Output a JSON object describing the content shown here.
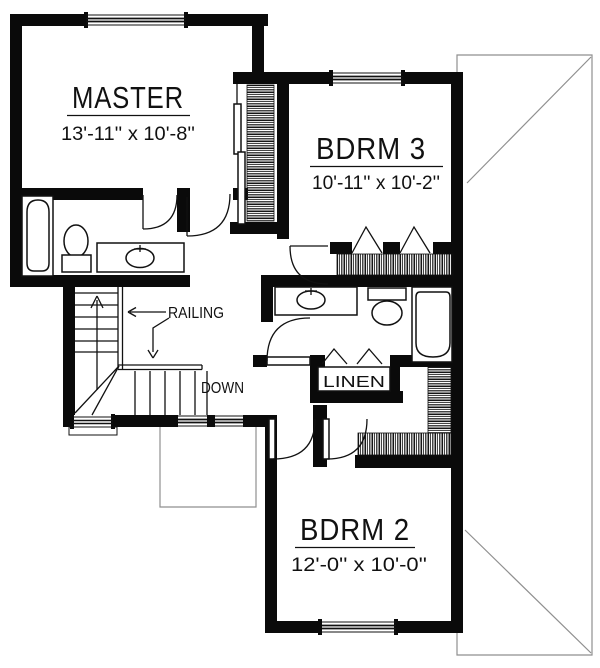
{
  "plan": {
    "rooms": {
      "master": {
        "name": "MASTER",
        "dims": "13'-11'' x 10'-8''"
      },
      "bdrm3": {
        "name": "BDRM 3",
        "dims": "10'-11'' x 10'-2''"
      },
      "bdrm2": {
        "name": "BDRM 2",
        "dims": "12'-0'' x 10'-0''"
      }
    },
    "labels": {
      "railing": "RAILING",
      "down": "DOWN",
      "linen": "LINEN"
    },
    "colors": {
      "wall": "#0a0a0a",
      "line": "#111111",
      "roof_line": "#8f8f8f",
      "background": "#ffffff"
    }
  }
}
